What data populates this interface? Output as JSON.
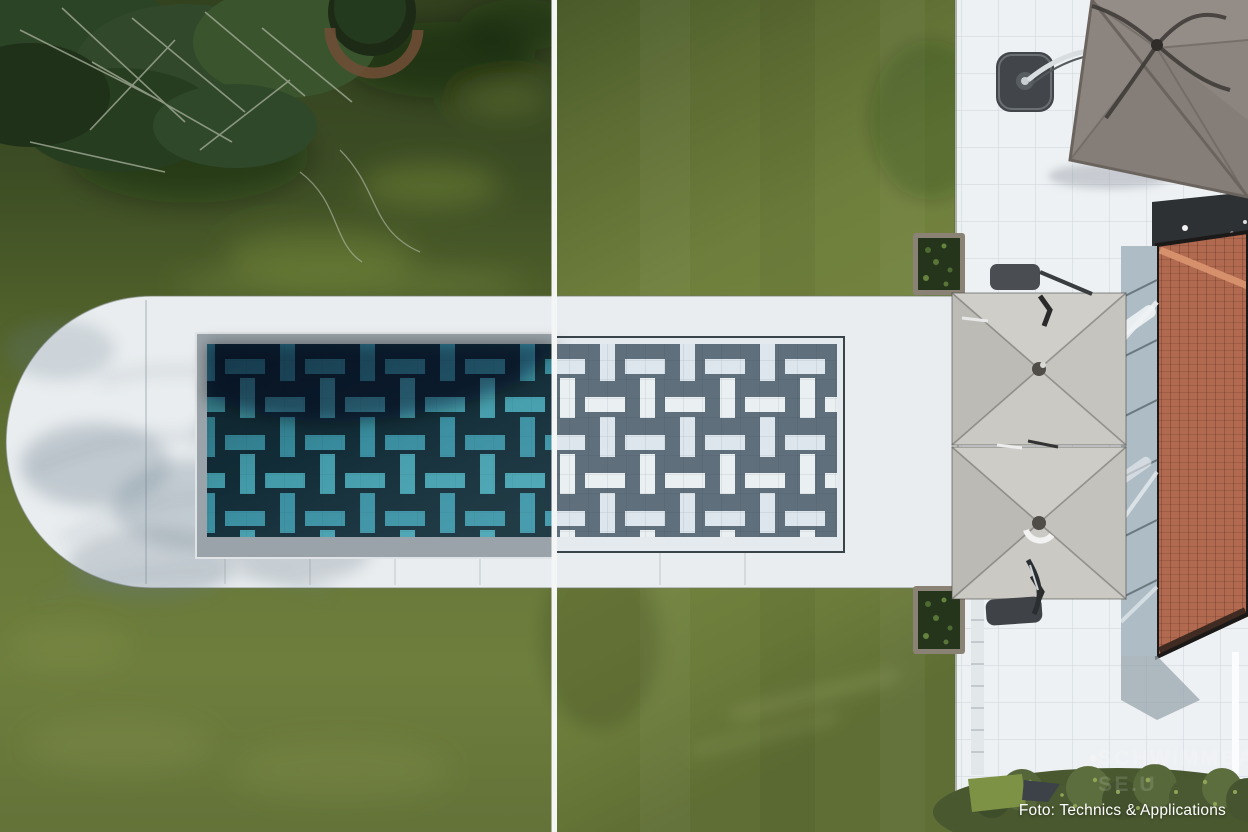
{
  "photo": {
    "caption": "Foto: Technics & Applications",
    "watermark_line1": "SCHWIMMBA",
    "watermark_line2": "SE.U"
  },
  "colors": {
    "paving": "#e9edef",
    "patio": "#eef1f3",
    "coping": "#99a3a9",
    "coverMargin": "#e5eaee",
    "poolNavy": "#14303b",
    "poolTeal": "#48a6b5",
    "poolTealAlt": "#3c96a8",
    "coverSlate": "#5f707c",
    "coverWhite": "#eaeff2",
    "coverWhiteAlt": "#dde6ec",
    "divider": "#f4f6f6",
    "umbrellaLight": "#c9c7c2",
    "umbrellaDark": "#8c857f",
    "roofBrick": "#b16a4f",
    "roofRidge": "#d8936e",
    "hedge": "#49582f",
    "grassRight": "#75853f",
    "grassLeft": "#52632c",
    "pondDark": "#33421f",
    "captionColor": "#ffffff"
  }
}
